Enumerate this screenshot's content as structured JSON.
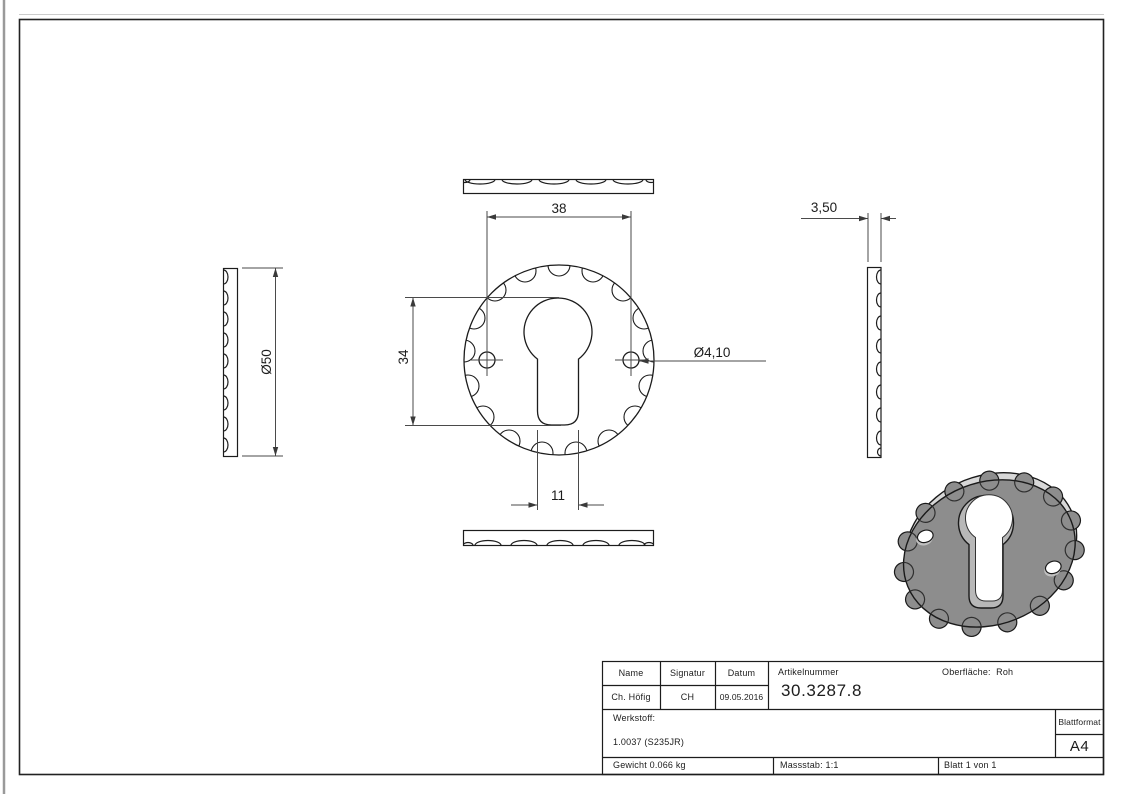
{
  "drawing": {
    "type": "technical-drawing",
    "part": "escutcheon-keyhole-rosette",
    "dimensions": {
      "hole_spacing": "38",
      "cutout_height": "34",
      "slot_width": "11",
      "outer_diameter": "Ø50",
      "hole_diameter": "Ø4,10",
      "thickness": "3,50"
    },
    "colors": {
      "line": "#1c1c1c",
      "dim_line": "#4a4a4a",
      "part_face": "#8d8d8d",
      "part_rim": "#d8d8d8",
      "keyhole_wall": "#b8b8b8"
    }
  },
  "title_block": {
    "name_label": "Name",
    "signature_label": "Signatur",
    "date_label": "Datum",
    "article_label": "Artikelnummer",
    "article_number": "30.3287.8",
    "surface_label": "Oberfläche:",
    "surface_value": "Roh",
    "name_value": "Ch. Höfig",
    "signature_value": "CH",
    "date_value": "09.05.2016",
    "material_label": "Werkstoff:",
    "material_value": "1.0037 (S235JR)",
    "sheet_format_label": "Blattformat",
    "sheet_format_value": "A4",
    "weight_text": "Gewicht 0.066 kg",
    "scale_text": "Massstab: 1:1",
    "sheet_text": "Blatt 1 von 1"
  }
}
